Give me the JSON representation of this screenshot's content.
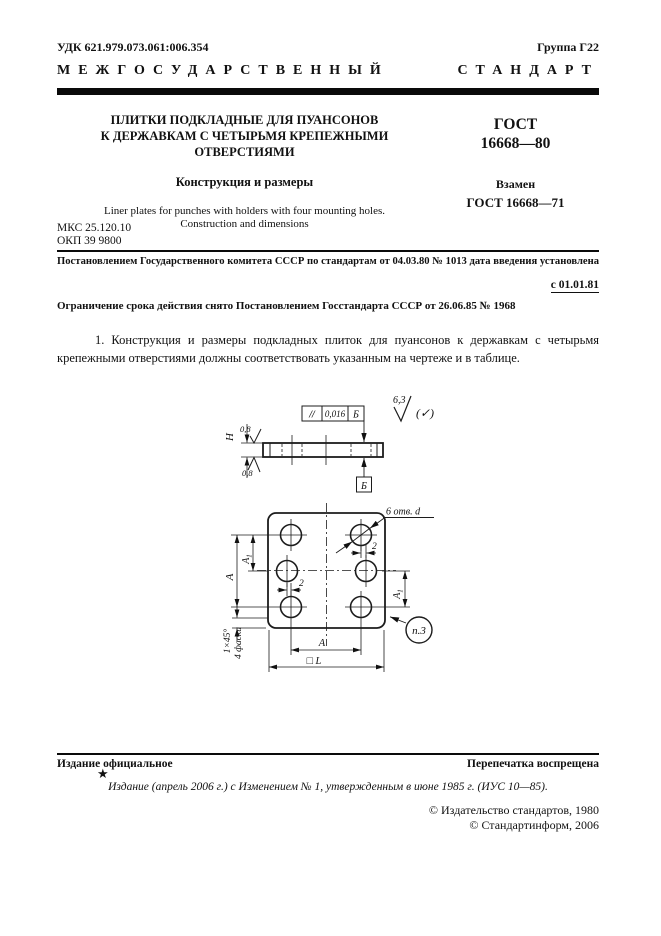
{
  "header": {
    "udk": "УДК 621.979.073.061:006.354",
    "group": "Группа Г22",
    "standard_kind_word1": "МЕЖГОСУДАРСТВЕННЫЙ",
    "standard_kind_word2": "СТАНДАРТ"
  },
  "title_block": {
    "title_line1": "ПЛИТКИ ПОДКЛАДНЫЕ ДЛЯ ПУАНСОНОВ",
    "title_line2": "К ДЕРЖАВКАМ С ЧЕТЫРЬМЯ КРЕПЕЖНЫМИ",
    "title_line3": "ОТВЕРСТИЯМИ",
    "subtitle": "Конструкция и размеры",
    "title_en_line1": "Liner plates for punches with holders with four mounting holes.",
    "title_en_line2": "Construction and dimensions",
    "gost_label": "ГОСТ",
    "gost_number": "16668—80",
    "replaces_label": "Взамен",
    "replaces_number": "ГОСТ 16668—71"
  },
  "codes": {
    "mks": "МКС 25.120.10",
    "okp": "ОКП 39 9800"
  },
  "decree": {
    "line1": "Постановлением Государственного комитета СССР по стандартам от 04.03.80 № 1013 дата введения установлена",
    "effective_date": "с 01.01.81",
    "line2": "Ограничение срока действия снято Постановлением Госстандарта СССР от 26.06.85  № 1968"
  },
  "body": {
    "paragraph1": "1. Конструкция и размеры подкладных плиток для пуансонов к державкам с четырьмя крепежными отверстиями должны соответствовать указанным на чертеже и в таблице."
  },
  "drawing": {
    "tolerance_frame": {
      "symbol": "//",
      "value": "0,016",
      "datum": "Б"
    },
    "datum_label": "Б",
    "height_label": "Н",
    "roughness_top": "0,8",
    "roughness_bottom": "0,8",
    "roughness_general": "6,3",
    "roughness_general_bracket": "(✓)",
    "holes_label": "6 отв. d",
    "dim_A": "А",
    "dim_A1_base": "А",
    "dim_A1_sub": "1",
    "dim_offset": "2",
    "dim_square_L": "□ L",
    "chamfer_size": "1×45°",
    "chamfer_count": "4 фаски",
    "ref_note": "п.3"
  },
  "footer": {
    "official": "Издание официальное",
    "reprint": "Перепечатка воспрещена",
    "star": "★",
    "edition_note": "Издание (апрель 2006 г.) с Изменением № 1, утвержденным в июне 1985 г. (ИУС 10—85).",
    "copyright1": "© Издательство стандартов, 1980",
    "copyright2": "© Стандартинформ, 2006"
  }
}
